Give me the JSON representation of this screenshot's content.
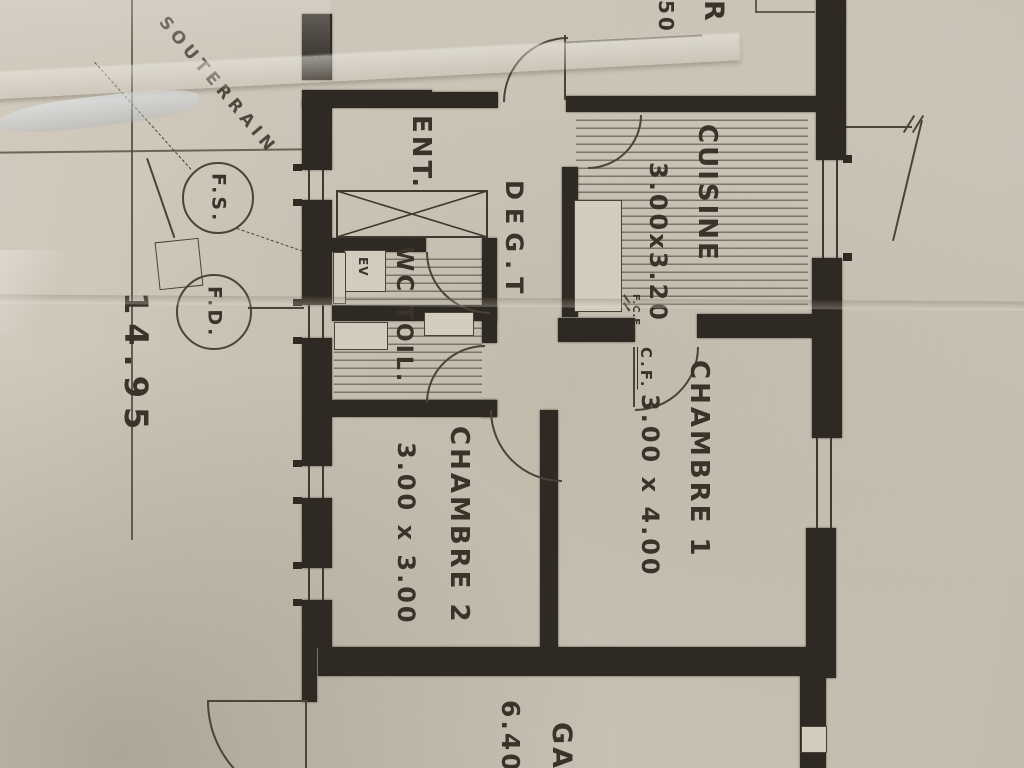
{
  "photo": {
    "description": "photograph of a hand-drawn architectural floor plan on creased paper"
  },
  "rooms": {
    "entree": {
      "label": "ENT."
    },
    "degagement": {
      "label": "DEG.T"
    },
    "wc": {
      "label": "WC"
    },
    "toilette": {
      "label": "TOIL."
    },
    "cuisine": {
      "label": "CUISINE",
      "dimensions": "3.00x3.20"
    },
    "chambre1": {
      "label": "CHAMBRE 1",
      "dimensions": "3.00 x 4.00"
    },
    "chambre2": {
      "label": "CHAMBRE 2",
      "dimensions": "3.00 x 3.00"
    },
    "garage": {
      "label_partial": "GA",
      "dimension_partial": "6.40"
    }
  },
  "fixtures": {
    "evier": {
      "label": "EV"
    }
  },
  "annotations": {
    "souterrain": {
      "label": "SOUTERRAIN"
    },
    "fosse_fs": {
      "label": "F.S."
    },
    "fosse_fd": {
      "label": "F.D."
    },
    "boundary_dimension": {
      "label": "14.95"
    },
    "conduit_cf": {
      "label": "C.F."
    },
    "conduit_fcf": {
      "label": "F.C.F."
    },
    "room_partial_r": {
      "label": "R"
    },
    "dim_partial_50": {
      "label": "50"
    }
  },
  "colors": {
    "paper": "#cac3b5",
    "ink": "#2e2922",
    "line": "#4a4336",
    "text": "#3a332a"
  }
}
